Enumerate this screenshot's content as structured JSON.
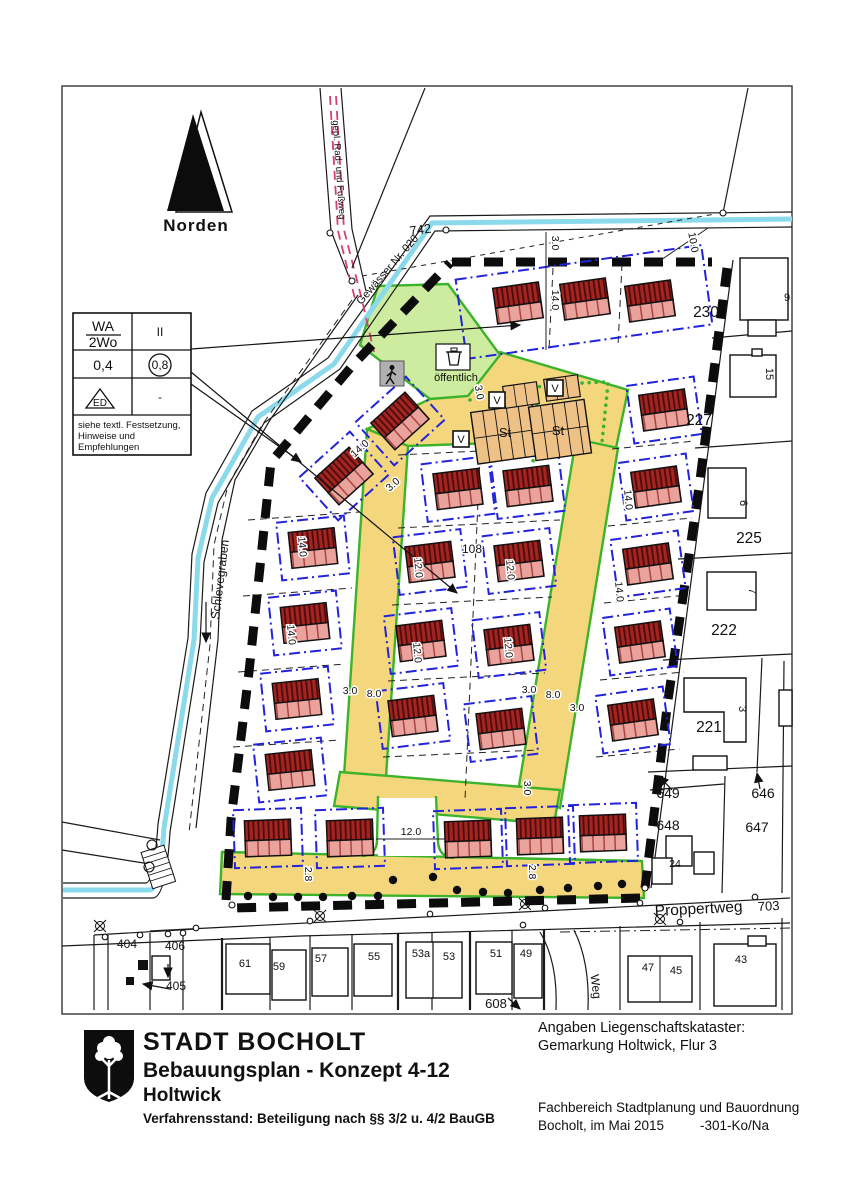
{
  "north": {
    "label": "Norden"
  },
  "legend": {
    "wa": "WA",
    "wo": "2Wo",
    "floors": "II",
    "grz": "0,4",
    "gfz": "0,8",
    "ed": "ED",
    "dash": "-",
    "note1": "siehe textl. Festsetzung,",
    "note2": "Hinweise und",
    "note3": "Empfehlungen"
  },
  "map_labels": {
    "gewaesser": "Gewässer Nr. 020",
    "radfussweg": "gepl. Rad- und Fußweg",
    "schlevegraben": "Schlevegraben",
    "oeffentlich": "öffentlich",
    "proppertweg": "Proppertweg",
    "weg": "Weg",
    "st": "St",
    "v": "V"
  },
  "parcel_numbers": {
    "p742": "742",
    "p230": "230",
    "p227": "227",
    "p225": "225",
    "p222": "222",
    "p221": "221",
    "p649": "649",
    "p646": "646",
    "p648": "648",
    "p647": "647",
    "p703": "703",
    "p108": "108",
    "p404": "404",
    "p406": "406",
    "p405": "405",
    "p608": "608"
  },
  "house_numbers": {
    "h9": "9",
    "h15": "15",
    "h6": "6",
    "h7": "7",
    "h3": "3",
    "h24": "24",
    "h61": "61",
    "h59": "59",
    "h57": "57",
    "h55": "55",
    "h53a": "53a",
    "h53": "53",
    "h51": "51",
    "h49": "49",
    "h47": "47",
    "h45": "45",
    "h43": "43"
  },
  "dimensions": {
    "d30": "3.0",
    "d140": "14.0",
    "d100": "10.0",
    "d80": "8.0",
    "d120": "12.0",
    "d28": "2.8"
  },
  "title_block": {
    "city": "STADT BOCHOLT",
    "plan": "Bebauungsplan - Konzept 4-12",
    "district": "Holtwick",
    "status": "Verfahrensstand: Beteiligung nach §§ 3/2 u. 4/2 BauGB"
  },
  "cadastre_block": {
    "line1": "Angaben Liegenschaftskataster:",
    "line2": "Gemarkung Holtwick, Flur 3",
    "dept": "Fachbereich Stadtplanung und Bauordnung",
    "place_date": "Bocholt, im Mai 2015",
    "ref": "-301-Ko/Na"
  },
  "colors": {
    "road_yellow": "#f4d77c",
    "public_green": "#cdec9f",
    "edge_green": "#3db32c",
    "building_red": "#a32420",
    "building_pink": "#e9a29c",
    "envelope_blue": "#2323dc",
    "water_cyan": "#8adaec",
    "path_pink": "#d6406f",
    "parking_tan": "#eec187"
  }
}
